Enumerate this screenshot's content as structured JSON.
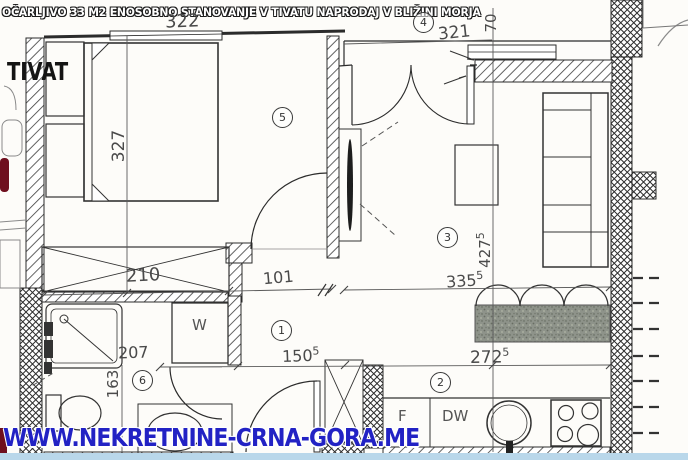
{
  "banner": {
    "title": "OČARLJIVO 33 M2 ENOSOBNO STANOVANJE V TIVATU NAPRODAJ V BLIŽINI MORJA"
  },
  "location_label": "TIVAT",
  "watermark": "WWW.NEKRETNINE-CRNA-GORA.ME",
  "rooms": {
    "hall": "1",
    "kitchen": "2",
    "living": "3",
    "balcony": "4",
    "bedroom": "5",
    "bathroom": "6"
  },
  "fixtures": {
    "wardrobe": "W",
    "fridge": "F",
    "dishwasher": "DW"
  },
  "dimensions": {
    "bedroom_width": "322",
    "bedroom_length": "327",
    "balcony_width": "321",
    "balcony_depth": "70",
    "wardrobe_width": "210",
    "hall_opening": "101",
    "hall_width": {
      "base": "150",
      "sup": "5"
    },
    "bath_width": "207",
    "bath_length": "163",
    "living_length": {
      "base": "427",
      "sup": "5"
    },
    "living_width": {
      "base": "335",
      "sup": "5"
    },
    "kitchen_width": {
      "base": "272",
      "sup": "5"
    }
  },
  "colors": {
    "watermark_blue": "#2222c4",
    "stamp_red": "#6f0f1e",
    "table_fill": "#8e938a",
    "scan_edge_blue": "#b9d7ea",
    "line": "#2b2b2b"
  }
}
